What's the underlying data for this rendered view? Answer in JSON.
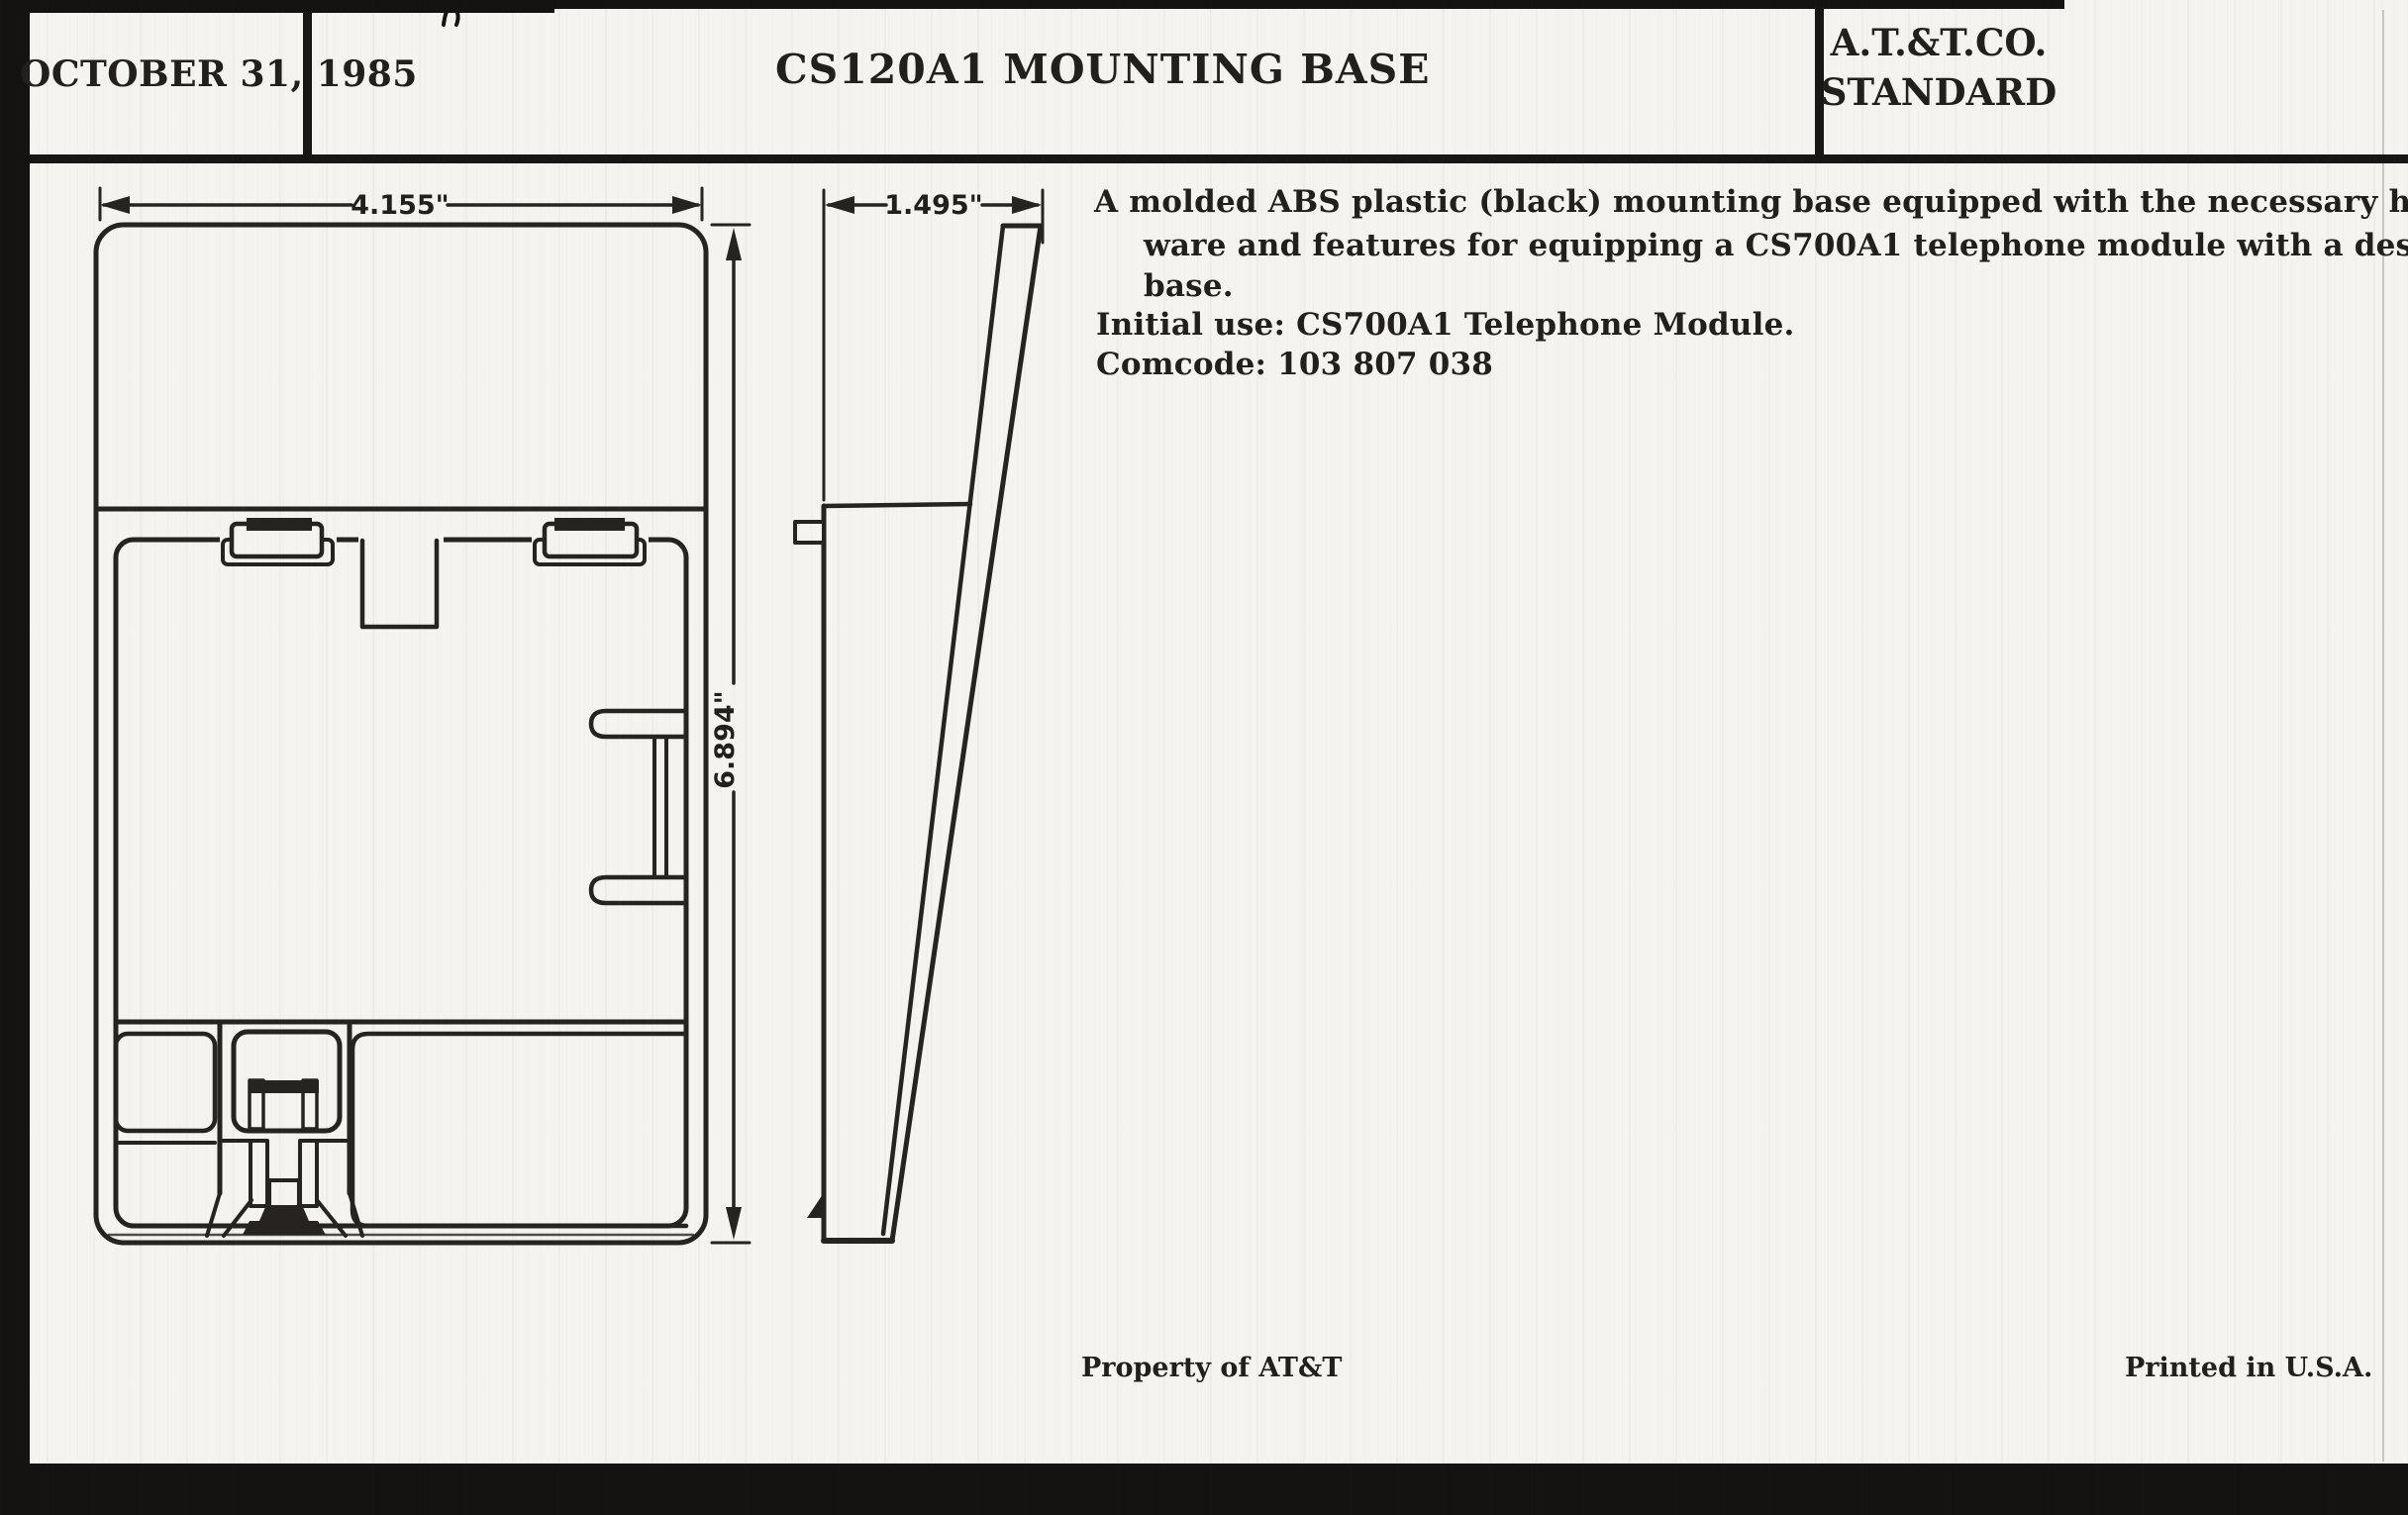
{
  "document": {
    "header": {
      "date": "OCTOBER 31, 1985",
      "title": "CS120A1 MOUNTING BASE",
      "standard": [
        "A.T.&T.CO.",
        "STANDARD"
      ]
    },
    "description": {
      "lines": [
        "A molded ABS plastic (black) mounting base equipped with the necessary hard-",
        "ware and features for equipping a CS700A1 telephone module with a desk",
        "base.",
        "Initial use: CS700A1 Telephone Module.",
        "Comcode: 103 807 038"
      ]
    },
    "dimensions": {
      "width": "4.155\"",
      "depth": "1.495\"",
      "height": "6.894\""
    },
    "footer": {
      "property": "Property of AT&T",
      "printed": "Printed in U.S.A."
    },
    "colors": {
      "ink": "#221f1c",
      "paper": "#f4f3ef"
    }
  }
}
